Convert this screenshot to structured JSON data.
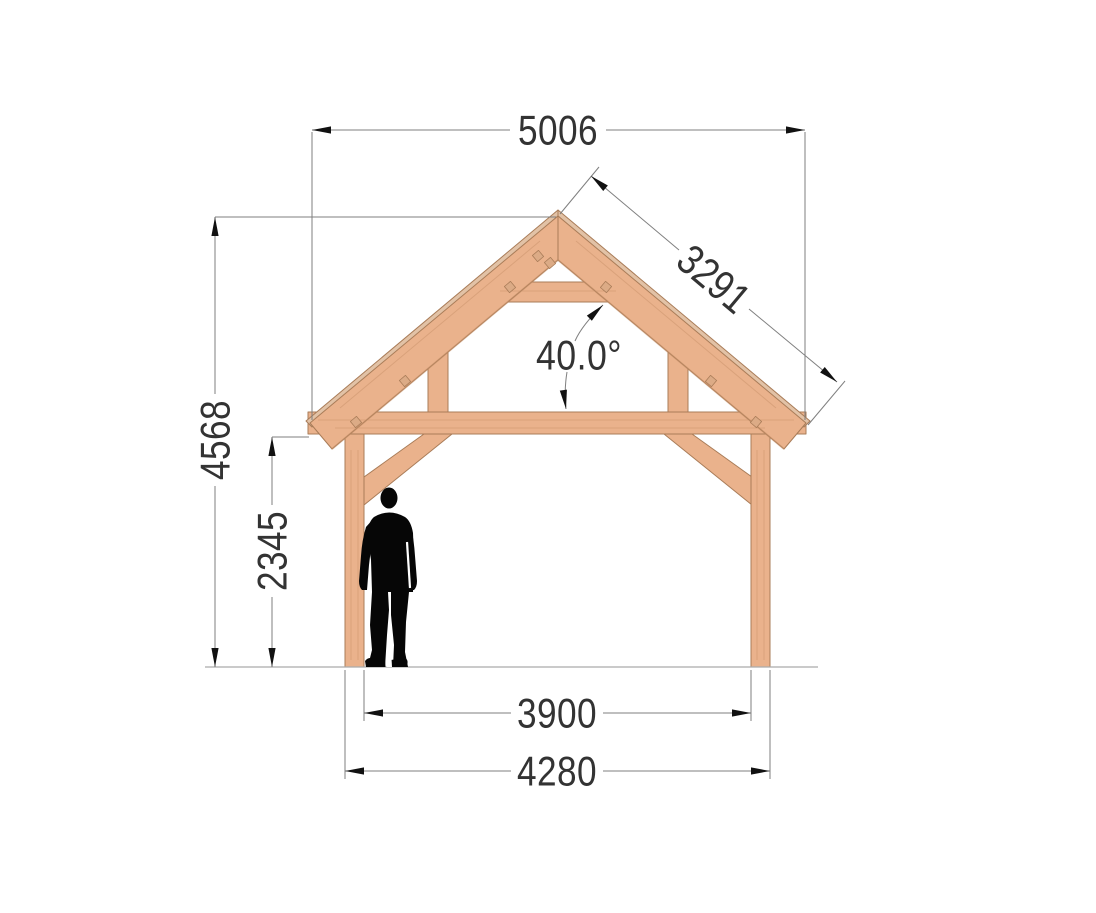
{
  "drawing": {
    "subject": "Timber frame canopy front elevation",
    "view": "front elevation with human scale figure"
  },
  "dimensions": {
    "roof_overall_width": "5006",
    "rafter_slope_length": "3291",
    "roof_angle": "40.0°",
    "overall_height": "4568",
    "clear_height_under_eave": "2345",
    "inner_post_span": "3900",
    "outer_post_span": "4280"
  },
  "colors": {
    "background": "#ffffff",
    "wood": "#eab28c",
    "deck": "#e2c2a6",
    "peg": "#dcab86",
    "wood_edge": "#a97c58",
    "wood_shadow": "#c58e66",
    "dim_line": "#7f7f7f",
    "dim_text": "#333333",
    "arrow": "#111111",
    "ground": "#ababab",
    "person": "#060606"
  }
}
